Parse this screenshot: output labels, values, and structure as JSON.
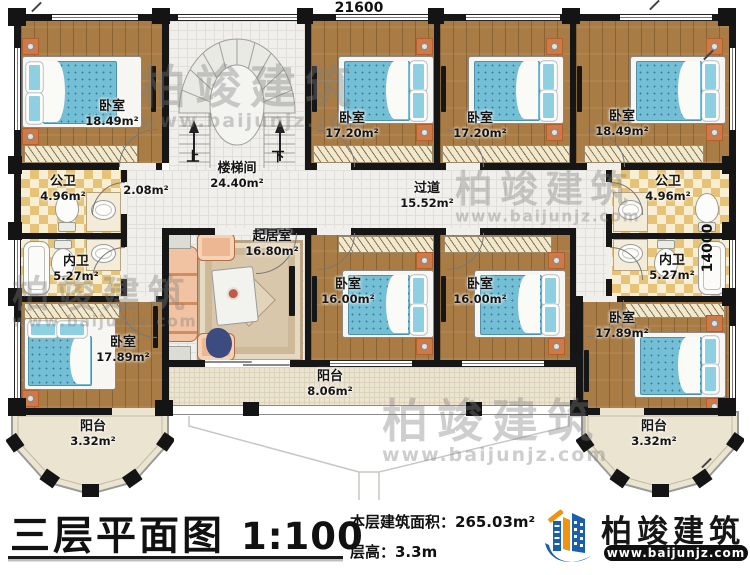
{
  "dimensions": {
    "width_top": "21600",
    "height_right": "14000"
  },
  "stair": {
    "up": "上",
    "down": "下"
  },
  "rooms": {
    "bedroom_tl": {
      "name": "卧室",
      "area": "18.49m²"
    },
    "stairwell": {
      "name": "楼梯间",
      "area": "24.40m²"
    },
    "bedroom_t2": {
      "name": "卧室",
      "area": "17.20m²"
    },
    "bedroom_t3": {
      "name": "卧室",
      "area": "17.20m²"
    },
    "bedroom_tr": {
      "name": "卧室",
      "area": "18.49m²"
    },
    "public_bath_left": {
      "name": "公卫",
      "area": "4.96m²"
    },
    "hall_niche": {
      "area": "2.08m²"
    },
    "hallway": {
      "name": "过道",
      "area": "15.52m²"
    },
    "private_bath_left": {
      "name": "内卫",
      "area": "5.27m²"
    },
    "living_room": {
      "name": "起居室",
      "area": "16.80m²"
    },
    "bedroom_m1": {
      "name": "卧室",
      "area": "16.00m²"
    },
    "bedroom_m2": {
      "name": "卧室",
      "area": "16.00m²"
    },
    "public_bath_right": {
      "name": "公卫",
      "area": "4.96m²"
    },
    "private_bath_right": {
      "name": "内卫",
      "area": "5.27m²"
    },
    "bedroom_bl": {
      "name": "卧室",
      "area": "17.89m²"
    },
    "bedroom_br": {
      "name": "卧室",
      "area": "17.89m²"
    },
    "balcony_left": {
      "name": "阳台",
      "area": "3.32m²"
    },
    "balcony_center": {
      "name": "阳台",
      "area": "8.06m²"
    },
    "balcony_right": {
      "name": "阳台",
      "area": "3.32m²"
    }
  },
  "watermark": {
    "brand": "柏竣建筑",
    "url": "www.baijunjz.com"
  },
  "footer": {
    "title": "三层平面图",
    "scale": "1:100",
    "area_line": "本层建筑面积：265.03m²",
    "floor_height_line": "层高：3.3m",
    "brand": "柏竣建筑",
    "brand_url": "www.baijunjz.com"
  }
}
